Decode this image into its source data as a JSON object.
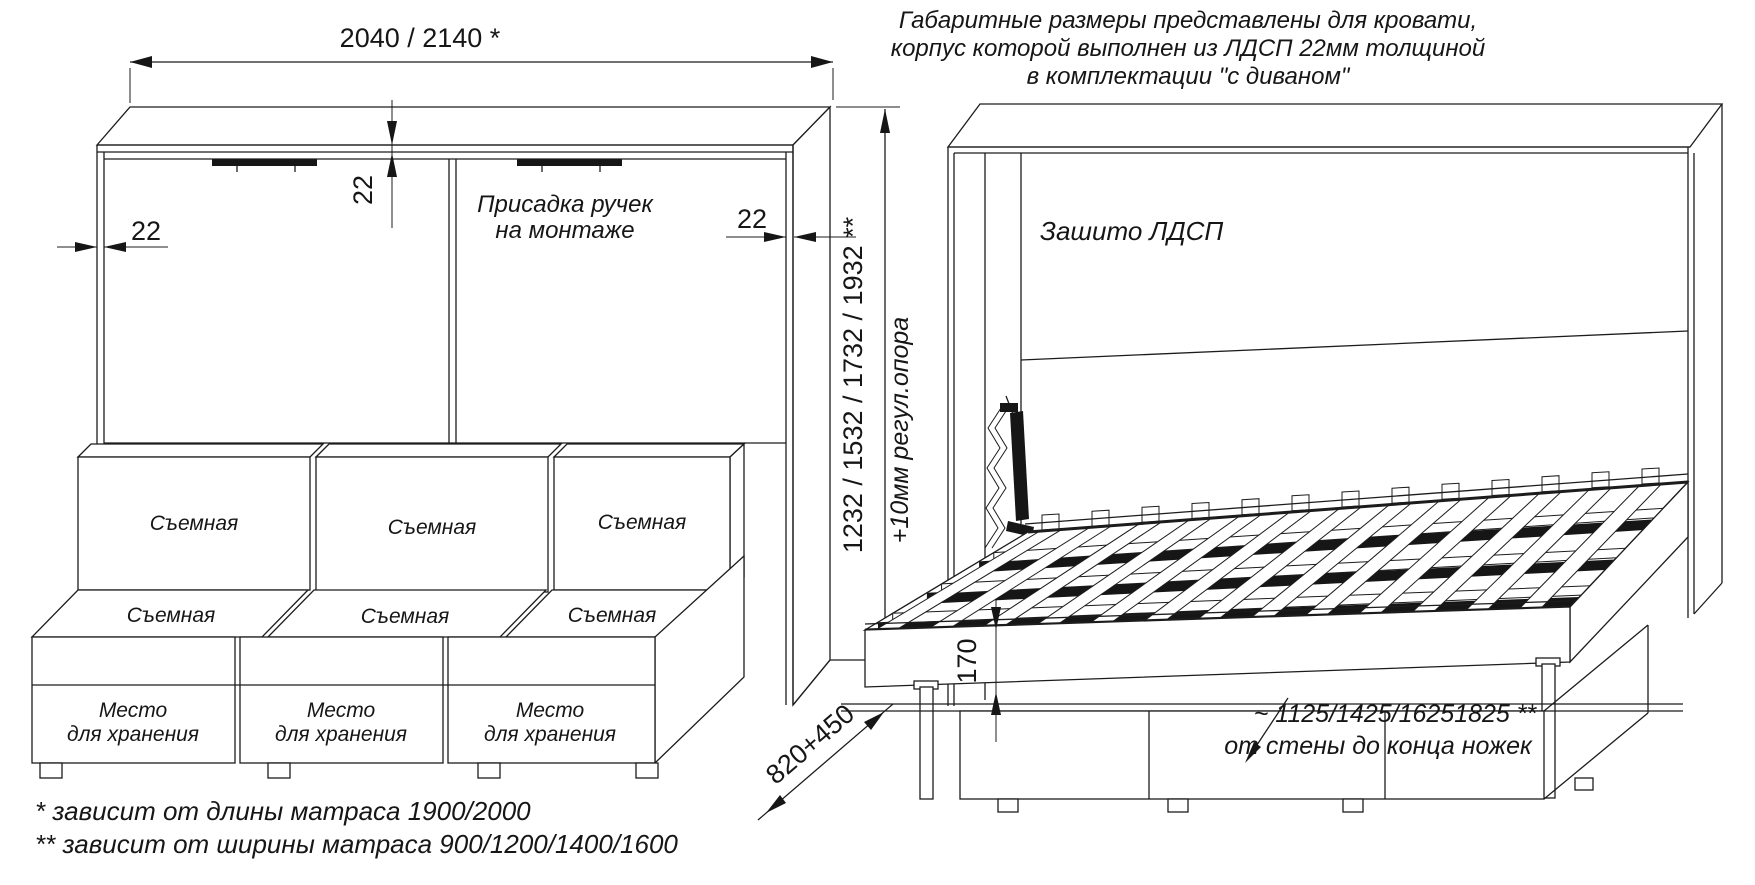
{
  "left_view": {
    "width_dim": "2040 / 2140 *",
    "panel_thickness_dims": [
      "22",
      "22",
      "22"
    ],
    "handle_note_line1": "Присадка ручек",
    "handle_note_line2": "на монтаже",
    "height_dim": "1232 / 1532 / 1732 / 1932 **",
    "height_note": "+10мм регул.опора",
    "depth_dim": "820+450",
    "back_cushions": [
      "Съемная",
      "Съемная",
      "Съемная"
    ],
    "seat_cushions": [
      "Съемная",
      "Съемная",
      "Съемная"
    ],
    "storage_boxes": [
      {
        "line1": "Место",
        "line2": "для хранения"
      },
      {
        "line1": "Место",
        "line2": "для хранения"
      },
      {
        "line1": "Место",
        "line2": "для хранения"
      }
    ]
  },
  "right_view": {
    "note_line1": "Габаритные размеры представлены для кровати,",
    "note_line2": "корпус которой выполнен из ЛДСП 22мм толщиной",
    "note_line3": "в комплектации \"с диваном\"",
    "panel_label": "Зашито ЛДСП",
    "base_height_dim": "170",
    "legs_dim": "~ 1125/1425/16251825 **",
    "legs_dim_note": "от стены до конца ножек"
  },
  "footnotes": {
    "first": "*  зависит от длины матраса 1900/2000",
    "second": "** зависит от ширины матраса 900/1200/1400/1600"
  },
  "colors": {
    "line": "#1c1c1c",
    "background": "#ffffff"
  }
}
